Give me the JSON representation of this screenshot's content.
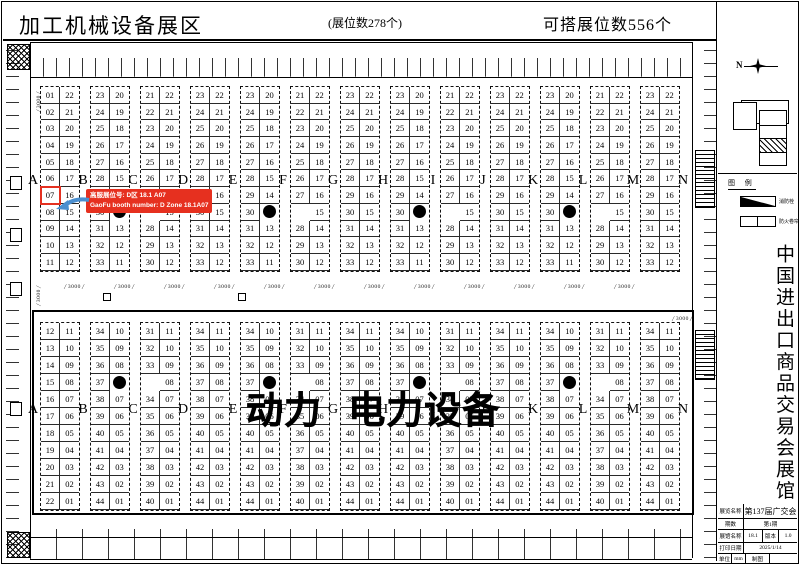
{
  "header": {
    "title": "加工机械设备展区",
    "booth_count": "(展位数278个)",
    "buildable_count": "可搭展位数556个"
  },
  "callout": {
    "line1": "高服展位号: D区 18.1 A07",
    "line2": "GaoFu booth number: D Zone 18.1A07",
    "color": "#e6301f"
  },
  "highlight": {
    "section": "top",
    "group": 0,
    "column": "left",
    "row": 6,
    "booth": "07"
  },
  "letters": [
    "A",
    "B",
    "C",
    "D",
    "E",
    "F",
    "G",
    "H",
    "I",
    "J",
    "K",
    "L",
    "M",
    "N"
  ],
  "big_label": "动力 电力设备",
  "aisle_dimension": "3000",
  "top_section": {
    "groups": [
      {
        "left": [
          "01",
          "02",
          "03",
          "04",
          "05",
          "06",
          "07",
          "08",
          "09",
          "10",
          "11"
        ],
        "right": [
          "22",
          "21",
          "20",
          "19",
          "18",
          "17",
          "16",
          "15",
          "14",
          "13",
          "12"
        ]
      },
      {
        "left": [
          "23",
          "24",
          "25",
          "26",
          "27",
          "28",
          "29",
          "30",
          "31",
          "32",
          "33"
        ],
        "right": [
          "20",
          "19",
          "18",
          "17",
          "16",
          "15",
          "14",
          "DOT",
          "13",
          "12",
          "11"
        ]
      },
      {
        "left": [
          "21",
          "22",
          "23",
          "24",
          "25",
          "26",
          "27",
          "",
          "28",
          "29",
          "30"
        ],
        "right": [
          "22",
          "21",
          "20",
          "19",
          "18",
          "17",
          "16",
          "15",
          "14",
          "13",
          "12"
        ]
      },
      {
        "left": [
          "23",
          "24",
          "25",
          "26",
          "27",
          "28",
          "29",
          "30",
          "31",
          "32",
          "33"
        ],
        "right": [
          "22",
          "21",
          "20",
          "19",
          "18",
          "17",
          "16",
          "15",
          "14",
          "13",
          "12"
        ]
      },
      {
        "left": [
          "23",
          "24",
          "25",
          "26",
          "27",
          "28",
          "29",
          "30",
          "31",
          "32",
          "33"
        ],
        "right": [
          "20",
          "19",
          "18",
          "17",
          "16",
          "15",
          "14",
          "DOT",
          "13",
          "12",
          "11"
        ]
      },
      {
        "left": [
          "21",
          "22",
          "23",
          "24",
          "25",
          "26",
          "27",
          "",
          "28",
          "29",
          "30"
        ],
        "right": [
          "22",
          "21",
          "20",
          "19",
          "18",
          "17",
          "16",
          "15",
          "14",
          "13",
          "12"
        ]
      },
      {
        "left": [
          "23",
          "24",
          "25",
          "26",
          "27",
          "28",
          "29",
          "30",
          "31",
          "32",
          "33"
        ],
        "right": [
          "22",
          "21",
          "20",
          "19",
          "18",
          "17",
          "16",
          "15",
          "14",
          "13",
          "12"
        ]
      },
      {
        "left": [
          "23",
          "24",
          "25",
          "26",
          "27",
          "28",
          "29",
          "30",
          "31",
          "32",
          "33"
        ],
        "right": [
          "20",
          "19",
          "18",
          "17",
          "16",
          "15",
          "14",
          "DOT",
          "13",
          "12",
          "11"
        ]
      },
      {
        "left": [
          "21",
          "22",
          "23",
          "24",
          "25",
          "26",
          "27",
          "",
          "28",
          "29",
          "30"
        ],
        "right": [
          "22",
          "21",
          "20",
          "19",
          "18",
          "17",
          "16",
          "15",
          "14",
          "13",
          "12"
        ]
      },
      {
        "left": [
          "23",
          "24",
          "25",
          "26",
          "27",
          "28",
          "29",
          "30",
          "31",
          "32",
          "33"
        ],
        "right": [
          "22",
          "21",
          "20",
          "19",
          "18",
          "17",
          "16",
          "15",
          "14",
          "13",
          "12"
        ]
      },
      {
        "left": [
          "23",
          "24",
          "25",
          "26",
          "27",
          "28",
          "29",
          "30",
          "31",
          "32",
          "33"
        ],
        "right": [
          "20",
          "19",
          "18",
          "17",
          "16",
          "15",
          "14",
          "DOT",
          "13",
          "12",
          "11"
        ]
      },
      {
        "left": [
          "21",
          "22",
          "23",
          "24",
          "25",
          "26",
          "27",
          "",
          "28",
          "29",
          "30"
        ],
        "right": [
          "22",
          "21",
          "20",
          "19",
          "18",
          "17",
          "16",
          "15",
          "14",
          "13",
          "12"
        ]
      },
      {
        "left": [
          "23",
          "24",
          "25",
          "26",
          "27",
          "28",
          "29",
          "30",
          "31",
          "32",
          "33"
        ],
        "right": [
          "22",
          "21",
          "20",
          "19",
          "18",
          "17",
          "16",
          "15",
          "14",
          "13",
          "12"
        ]
      }
    ]
  },
  "bottom_section": {
    "groups": [
      {
        "left": [
          "12",
          "13",
          "14",
          "15",
          "16",
          "17",
          "18",
          "19",
          "20",
          "21",
          "22"
        ],
        "right": [
          "11",
          "10",
          "09",
          "08",
          "07",
          "06",
          "05",
          "04",
          "03",
          "02",
          "01"
        ]
      },
      {
        "left": [
          "34",
          "35",
          "36",
          "37",
          "38",
          "39",
          "40",
          "41",
          "42",
          "43",
          "44"
        ],
        "right": [
          "10",
          "09",
          "08",
          "DOT",
          "07",
          "06",
          "05",
          "04",
          "03",
          "02",
          "01"
        ]
      },
      {
        "left": [
          "31",
          "32",
          "33",
          "",
          "34",
          "35",
          "36",
          "37",
          "38",
          "39",
          "40"
        ],
        "right": [
          "11",
          "10",
          "09",
          "08",
          "07",
          "06",
          "05",
          "04",
          "03",
          "02",
          "01"
        ]
      },
      {
        "left": [
          "34",
          "35",
          "36",
          "37",
          "38",
          "39",
          "40",
          "41",
          "42",
          "43",
          "44"
        ],
        "right": [
          "11",
          "10",
          "09",
          "08",
          "07",
          "06",
          "05",
          "04",
          "03",
          "02",
          "01"
        ]
      },
      {
        "left": [
          "34",
          "35",
          "36",
          "37",
          "38",
          "39",
          "40",
          "41",
          "42",
          "43",
          "44"
        ],
        "right": [
          "10",
          "09",
          "08",
          "DOT",
          "07",
          "06",
          "05",
          "04",
          "03",
          "02",
          "01"
        ]
      },
      {
        "left": [
          "31",
          "32",
          "33",
          "",
          "34",
          "35",
          "36",
          "37",
          "38",
          "39",
          "40"
        ],
        "right": [
          "11",
          "10",
          "09",
          "08",
          "07",
          "06",
          "05",
          "04",
          "03",
          "02",
          "01"
        ]
      },
      {
        "left": [
          "34",
          "35",
          "36",
          "37",
          "38",
          "39",
          "40",
          "41",
          "42",
          "43",
          "44"
        ],
        "right": [
          "11",
          "10",
          "09",
          "08",
          "07",
          "06",
          "05",
          "04",
          "03",
          "02",
          "01"
        ]
      },
      {
        "left": [
          "34",
          "35",
          "36",
          "37",
          "38",
          "39",
          "40",
          "41",
          "42",
          "43",
          "44"
        ],
        "right": [
          "10",
          "09",
          "08",
          "DOT",
          "07",
          "06",
          "05",
          "04",
          "03",
          "02",
          "01"
        ]
      },
      {
        "left": [
          "31",
          "32",
          "33",
          "",
          "34",
          "35",
          "36",
          "37",
          "38",
          "39",
          "40"
        ],
        "right": [
          "11",
          "10",
          "09",
          "08",
          "07",
          "06",
          "05",
          "04",
          "03",
          "02",
          "01"
        ]
      },
      {
        "left": [
          "34",
          "35",
          "36",
          "37",
          "38",
          "39",
          "40",
          "41",
          "42",
          "43",
          "44"
        ],
        "right": [
          "11",
          "10",
          "09",
          "08",
          "07",
          "06",
          "05",
          "04",
          "03",
          "02",
          "01"
        ]
      },
      {
        "left": [
          "34",
          "35",
          "36",
          "37",
          "38",
          "39",
          "40",
          "41",
          "42",
          "43",
          "44"
        ],
        "right": [
          "10",
          "09",
          "08",
          "DOT",
          "07",
          "06",
          "05",
          "04",
          "03",
          "02",
          "01"
        ]
      },
      {
        "left": [
          "31",
          "32",
          "33",
          "",
          "34",
          "35",
          "36",
          "37",
          "38",
          "39",
          "40"
        ],
        "right": [
          "11",
          "10",
          "09",
          "08",
          "07",
          "06",
          "05",
          "04",
          "03",
          "02",
          "01"
        ]
      },
      {
        "left": [
          "34",
          "35",
          "36",
          "37",
          "38",
          "39",
          "40",
          "41",
          "42",
          "43",
          "44"
        ],
        "right": [
          "11",
          "10",
          "09",
          "08",
          "07",
          "06",
          "05",
          "04",
          "03",
          "02",
          "01"
        ]
      }
    ]
  },
  "side_panel": {
    "compass": "N",
    "legend": {
      "title": "图 例",
      "items": [
        {
          "label": "消防栓"
        },
        {
          "label": "防火卷帘"
        }
      ]
    },
    "vertical_title": "中国进出口商品交易会展馆",
    "title_block": {
      "rows": [
        {
          "label": "展览名称",
          "value": "第137届广交会"
        },
        {
          "label": "期数",
          "value": "第1期"
        },
        {
          "label": "展馆名称",
          "value": "18.1",
          "label2": "版本",
          "value2": "1.0"
        },
        {
          "label": "打印日期",
          "value": "2025/1/14"
        },
        {
          "label": "单位",
          "value": "mm",
          "label2": "制图",
          "value2": ""
        }
      ]
    }
  }
}
